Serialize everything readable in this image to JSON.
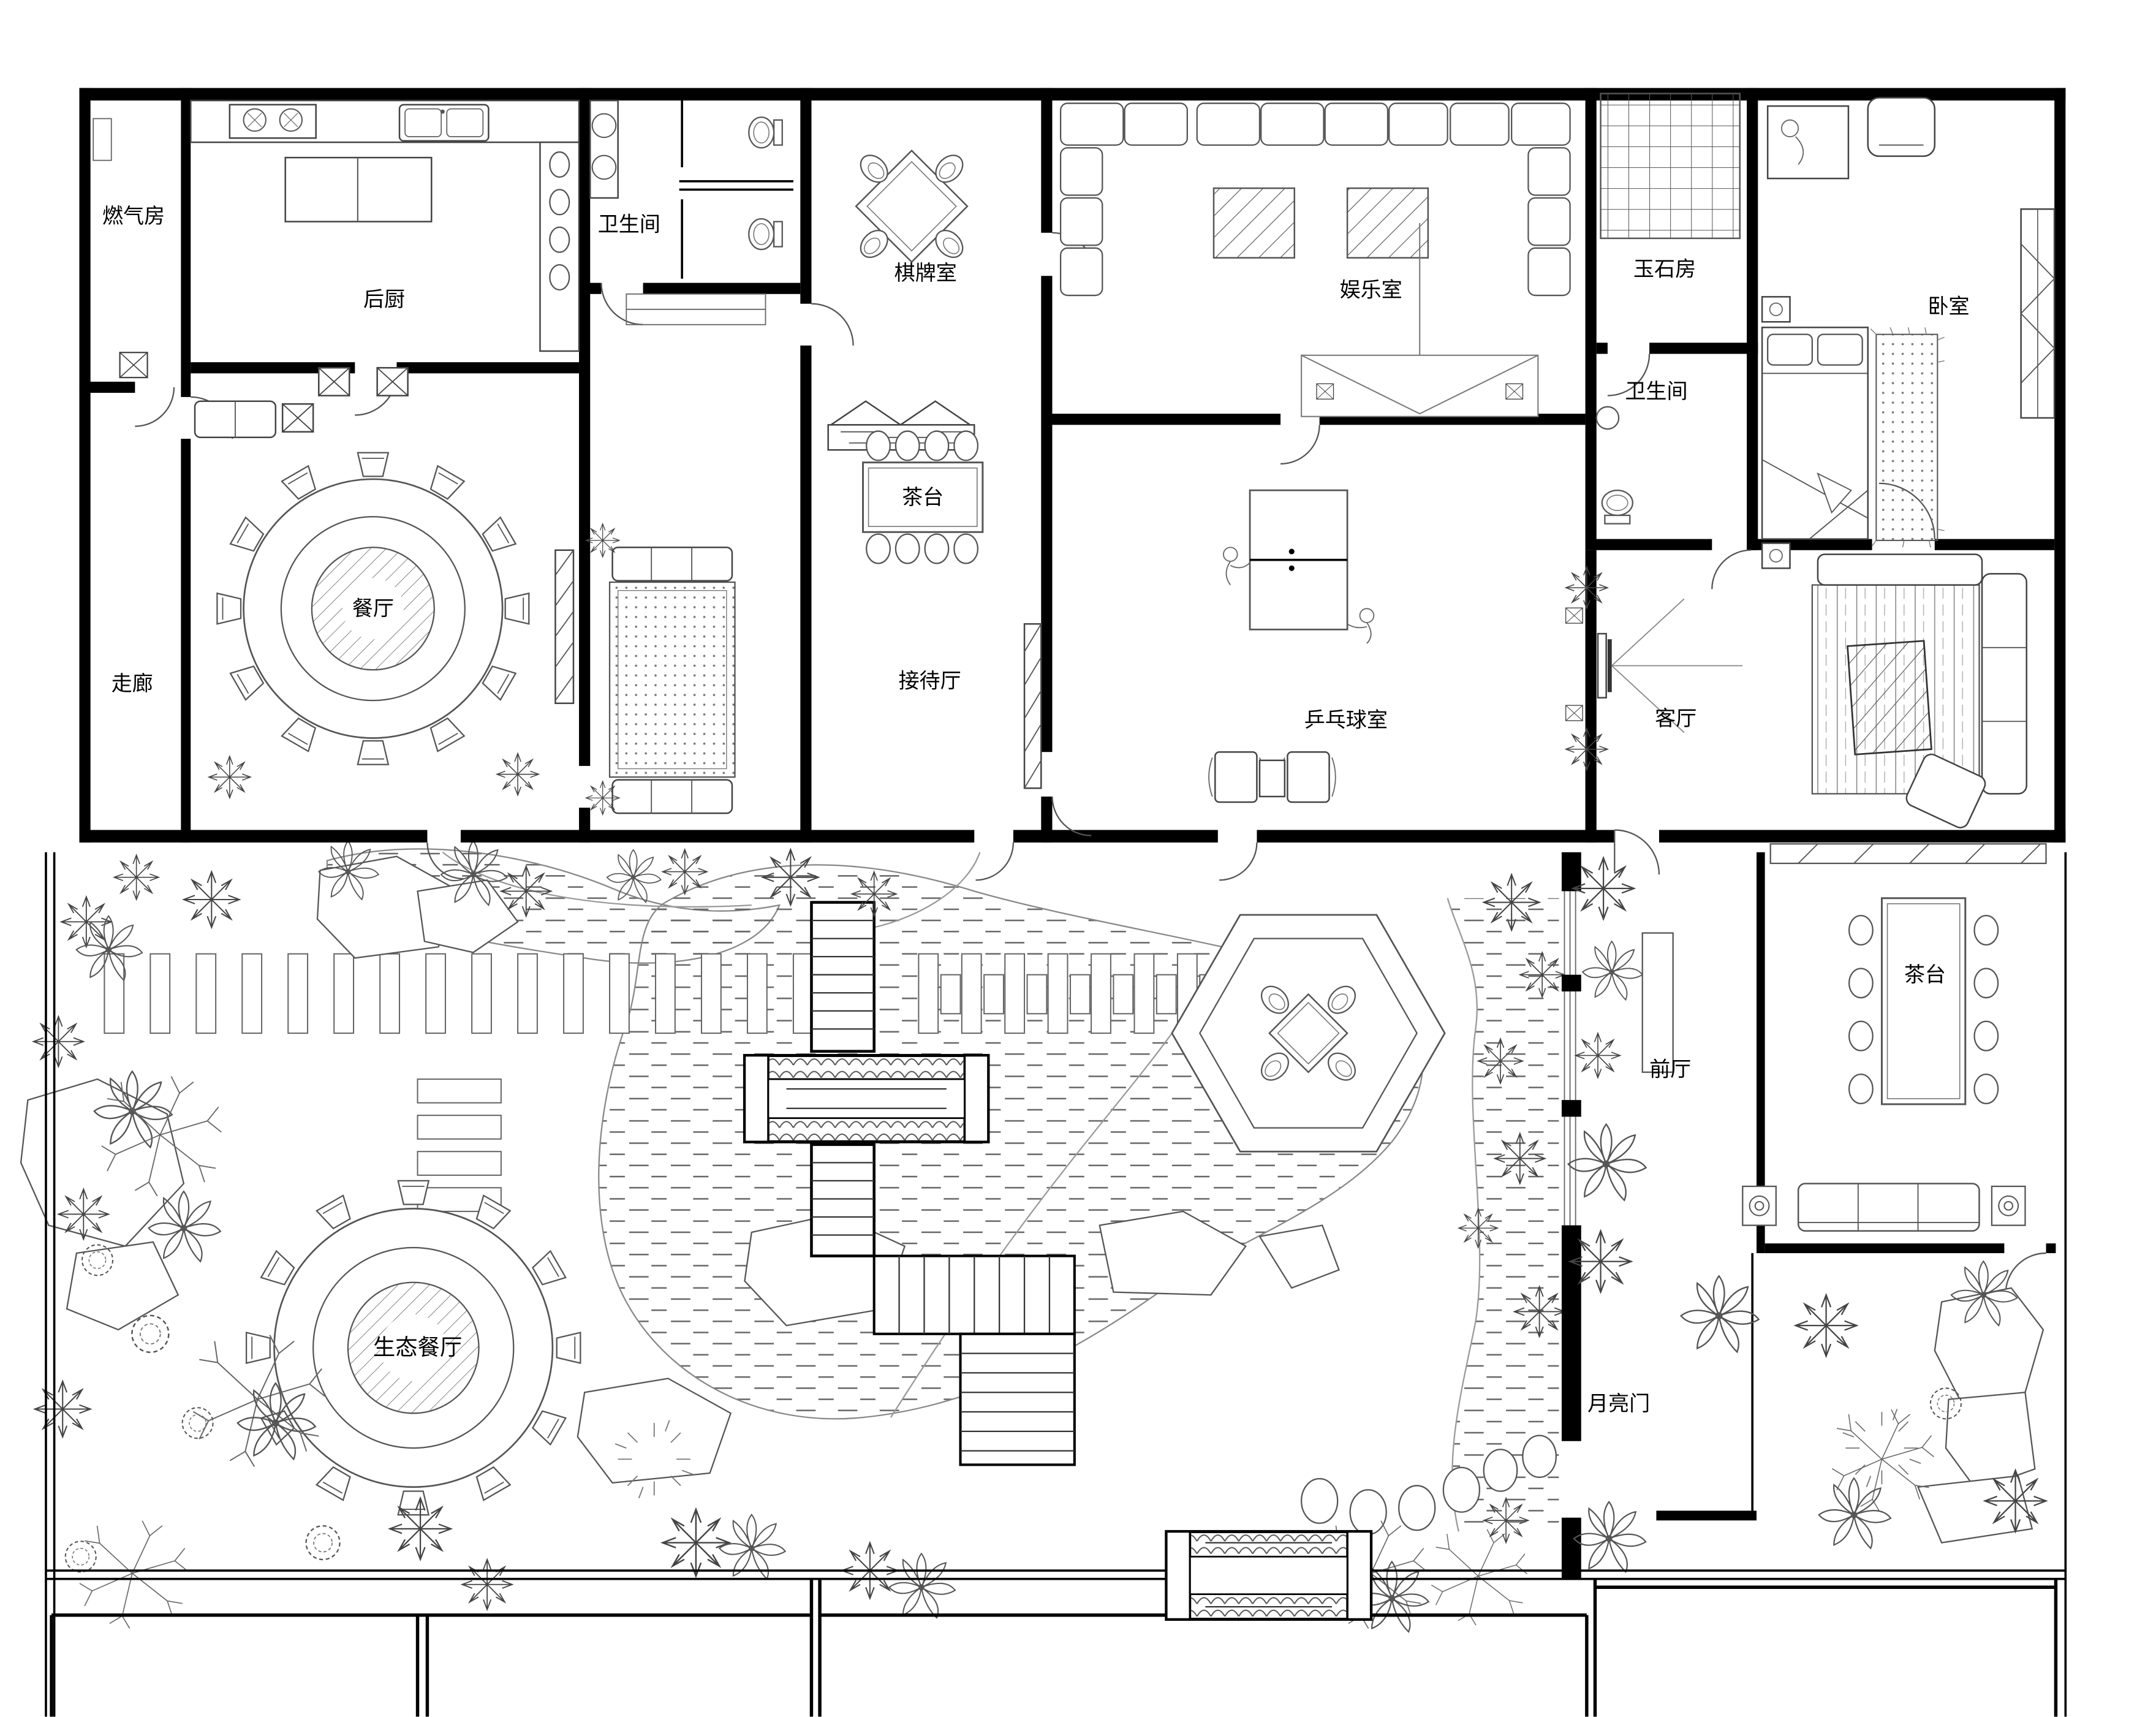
{
  "rooms": {
    "gas_room": "燃气房",
    "kitchen": "后厨",
    "bath_top": "卫生间",
    "chess_room": "棋牌室",
    "entertainment": "娱乐室",
    "jade_room": "玉石房",
    "bedroom": "卧室",
    "bath_right": "卫生间",
    "dining": "餐厅",
    "corridor": "走廊",
    "tea_table_hall": "茶台",
    "reception": "接待厅",
    "pingpong": "乒乓球室",
    "living": "客厅",
    "tea_table_east": "茶台",
    "foyer": "前厅",
    "eco_dining": "生态餐厅",
    "moon_gate": "月亮门"
  },
  "colors": {
    "wall": "#000000",
    "furniture": "#444444",
    "water_dash": "#666666",
    "faint": "#999999",
    "background": "#ffffff"
  }
}
